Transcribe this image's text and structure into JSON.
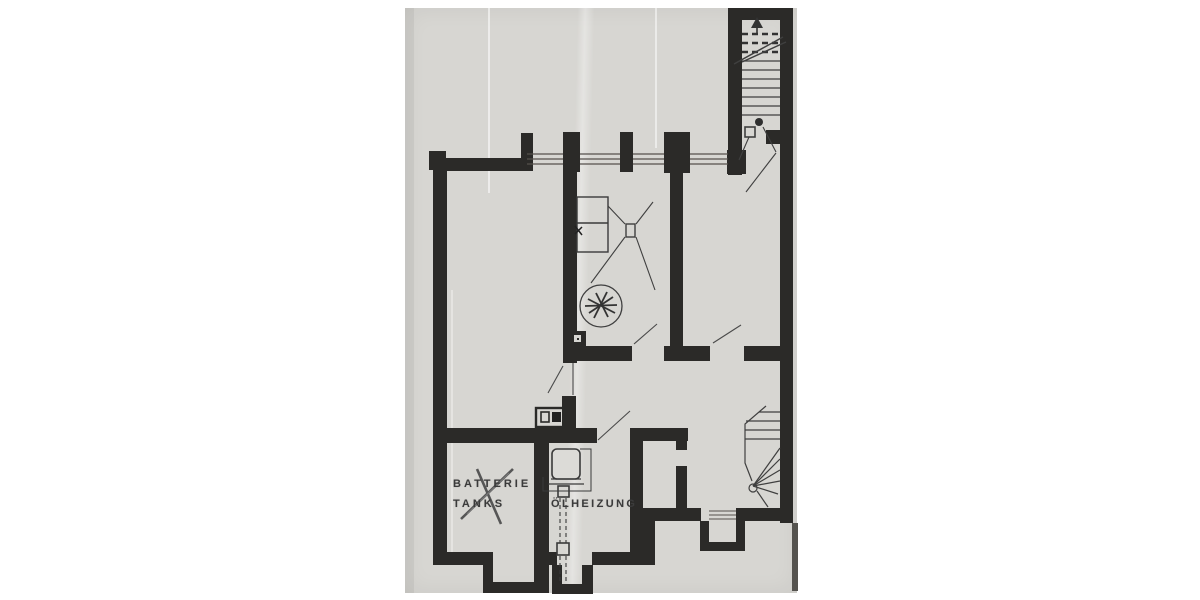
{
  "page": {
    "background_color": "#ffffff",
    "paper_color": "#d7d6d2",
    "wall_color": "#2b2a28",
    "line_color": "#3f3f3f",
    "text_color": "#3b3b3b",
    "kind": "scanned basement floor plan photocopy"
  },
  "plan": {
    "labels": {
      "battery_line1": "BATTERIE",
      "battery_line2": "TANKS",
      "heating": "ÖLHEIZUNG"
    },
    "annotations": {
      "battery_room_crossed_out": true
    },
    "symbols": [
      "upper-staircase",
      "stair-direction-arrow",
      "stair-break-line",
      "winder-staircase",
      "basement-window",
      "door-swing",
      "ceiling-light-wiring",
      "stairwell-light",
      "boiler",
      "chimney-flue-dashed",
      "drain-circle-scribble",
      "meter-boxes",
      "wall-box"
    ]
  }
}
